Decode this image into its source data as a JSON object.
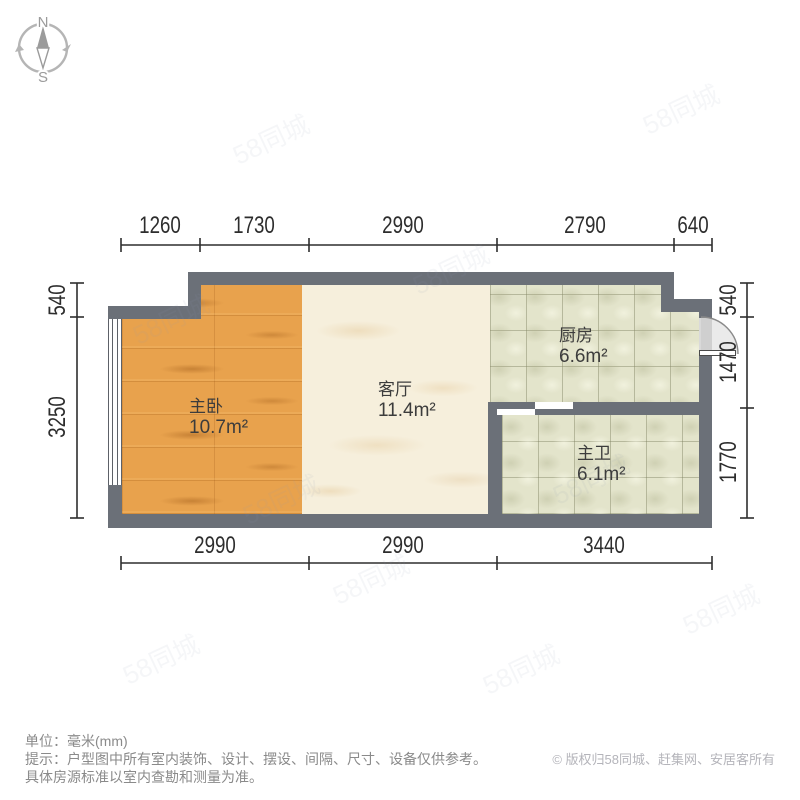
{
  "compass": {
    "north": "N",
    "south": "S"
  },
  "rooms": [
    {
      "name": "主卧",
      "area": "10.7m²"
    },
    {
      "name": "客厅",
      "area": "11.4m²"
    },
    {
      "name": "厨房",
      "area": "6.6m²"
    },
    {
      "name": "主卫",
      "area": "6.1m²"
    }
  ],
  "dimensions_mm": {
    "top": [
      "1260",
      "1730",
      "2990",
      "2790",
      "640"
    ],
    "bottom": [
      "2990",
      "2990",
      "3440"
    ],
    "left": [
      "540",
      "3250"
    ],
    "right": [
      "540",
      "1470",
      "1770"
    ]
  },
  "footer": {
    "unit_line": "单位：毫米(mm)",
    "tip_line1": "提示：户型图中所有室内装饰、设计、摆设、间隔、尺寸、设备仅供参考。",
    "tip_line2": "具体房源标准以室内查勘和测量为准。",
    "copyright": "© 版权归58同城、赶集网、安居客所有"
  },
  "watermark": {
    "text": "58同城"
  },
  "colors": {
    "wall": "#6b7078",
    "wood_floor": "#e8a24d",
    "marble_floor": "#f6efdc",
    "tile_floor": "#e3e4cb",
    "dimension_text": "#2d2d2d",
    "footer_text": "#8a8a8a",
    "copyright_text": "#b4b4ba"
  }
}
